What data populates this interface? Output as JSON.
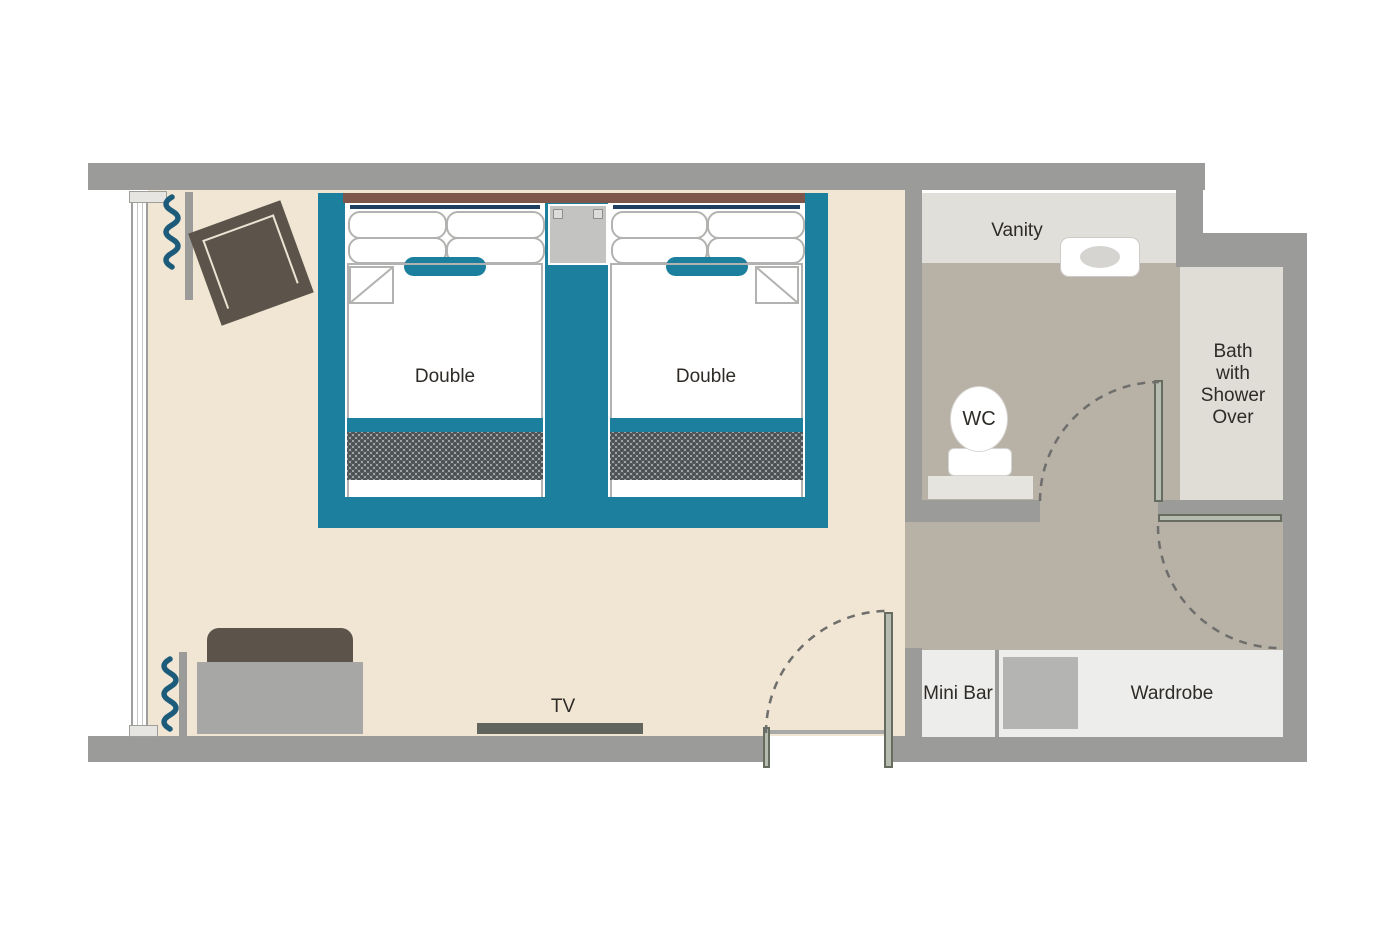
{
  "title": "Hotel Room Floor Plan",
  "labels": {
    "bed1": "Double",
    "bed2": "Double",
    "vanity": "Vanity",
    "wc": "WC",
    "bath": "Bath\nwith\nShower\nOver",
    "mini_bar": "Mini Bar",
    "wardrobe": "Wardrobe",
    "tv": "TV"
  },
  "colors": {
    "teal": "#1b7f9d",
    "navy": "#1e3f62",
    "floor_bedroom": "#f0e6d3",
    "floor_bathroom": "#b7b1a6",
    "wall": "#9b9b99",
    "vanity_counter": "#e1dfda",
    "bathtub": "#e0ddd7",
    "cabinet": "#ededec",
    "headboard": "#7c564b",
    "dark_furniture": "#5c544a",
    "sofa_seat": "#a7a7a5",
    "wardrobe_square": "#b4b4b2",
    "door_leaf": "#b7bcb0",
    "door_edge": "#676c61",
    "arc": "#6e6e6c",
    "curtain": "#1d5b7b",
    "tv": "#62655d",
    "pattern_base": "#a2a7a8",
    "pattern_dot": "#4b5154",
    "wc_mat": "#e6e4df",
    "text": "#2e2b27"
  }
}
